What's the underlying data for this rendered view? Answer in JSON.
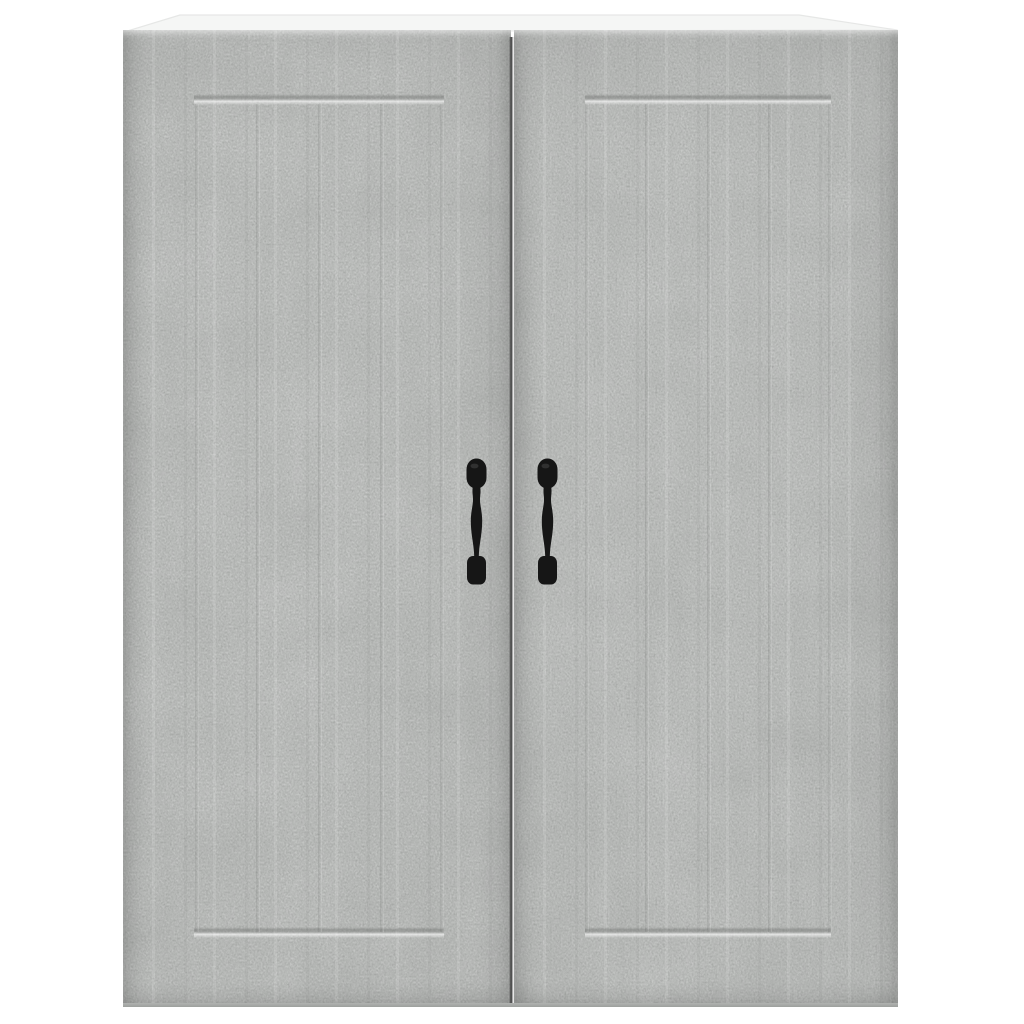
{
  "meta": {
    "type": "product-photo",
    "subject": "Wall-mounted cabinet with two doors, concrete grey finish, black vintage pull handles"
  },
  "palette": {
    "background": "#ffffff",
    "concrete_base": "#c2c4c2",
    "concrete_mottle": "#a9aba9",
    "concrete_speckle": "#767876",
    "top_surface": "#f5f6f5",
    "top_edge_line": "#e6e7e6",
    "door_gap": "#3c3c3c",
    "bottom_edge": "#9da09d",
    "handle": "#161616",
    "handle_highlight": "#3a3a3a"
  },
  "cabinet": {
    "parts": {
      "top_panel": "white top panel",
      "left_door": "left concrete-grey door",
      "right_door": "right concrete-grey door",
      "left_handle": "black spindle pull handle",
      "right_handle": "black spindle pull handle",
      "panel_grooves": "routed shaker panel grooves with plank lines"
    }
  }
}
